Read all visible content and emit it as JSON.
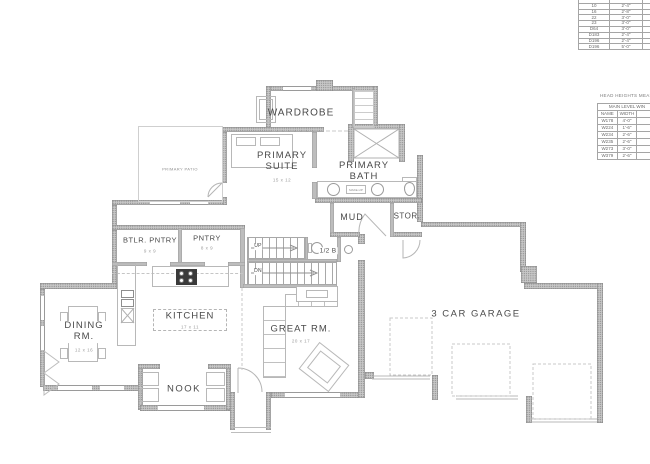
{
  "door_schedule": {
    "rows": [
      {
        "id": "",
        "w": ""
      },
      {
        "id": "10",
        "w": "2'-4\""
      },
      {
        "id": "16",
        "w": "2'-8\""
      },
      {
        "id": "22",
        "w": "3'-0\""
      },
      {
        "id": "23",
        "w": "3'-0\""
      },
      {
        "id": "D64",
        "w": "3'-0\""
      },
      {
        "id": "D183",
        "w": "2'-4\""
      },
      {
        "id": "D196",
        "w": "2'-4\""
      },
      {
        "id": "D196b",
        "w": "5'-0\""
      }
    ],
    "row8_id": "D196"
  },
  "head_heights": {
    "title": "HEAD HEIGHTS MEASUR",
    "table_title": "MAIN LEVEL WIN",
    "col_name": "NAME",
    "col_width": "WIDTH",
    "rows": [
      {
        "name": "W178",
        "w": "4'-0\""
      },
      {
        "name": "W224",
        "w": "1'-6\""
      },
      {
        "name": "W234",
        "w": "2'-6\""
      },
      {
        "name": "W235",
        "w": "2'-6\""
      },
      {
        "name": "W273",
        "w": "3'-0\""
      },
      {
        "name": "W379",
        "w": "2'-6\""
      }
    ]
  },
  "rooms": {
    "wardrobe": "WARDROBE",
    "primary_suite": "PRIMARY SUITE",
    "primary_suite_dim": "15 x 12",
    "primary_patio": "PRIMARY PATIO",
    "primary_bath": "PRIMARY BATH",
    "mud": "MUD",
    "stor": "STOR.",
    "btlr_pntry": "BTLR. PNTRY",
    "btlr_pntry_dim": "9 x 9",
    "pntry": "PNTRY",
    "pntry_dim": "8 x 9",
    "half_bath": "1/2 B",
    "kitchen": "KITCHEN",
    "kitchen_dim": "17 x 11",
    "dining": "DINING RM.",
    "dining_dim": "12 x 16",
    "great": "GREAT RM.",
    "great_dim": "20 x 17",
    "nook": "NOOK",
    "garage": "3 CAR GARAGE"
  },
  "stairs": {
    "up": "UP",
    "dn": "DN"
  },
  "fixtures": {
    "makeup": "MAKE-UP"
  },
  "colors": {
    "wall": "#c7c7c7",
    "line": "#a8a8a8",
    "text": "#4a4a4a"
  }
}
